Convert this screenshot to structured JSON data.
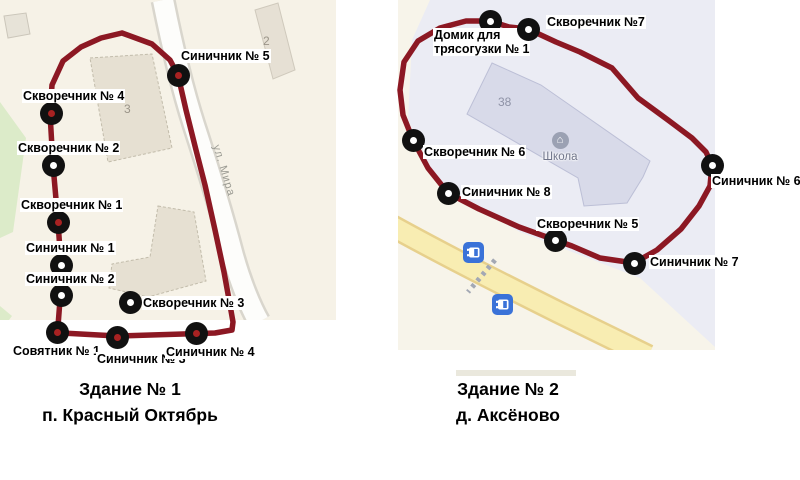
{
  "colors": {
    "route": "#8c1823",
    "marker_ring": "#111111",
    "marker_dot_red": "#a82222",
    "marker_dot_white": "#ffffff",
    "bus_badge_blue": "#3a72d8",
    "school_building": "#d8dae9",
    "map1_background": "#f6f2e7",
    "map2_background": "#ebecf4",
    "yellow_road": "#f8edb2"
  },
  "maps": [
    {
      "id": "map-1",
      "caption_line1": "Здание № 1",
      "caption_line2": "п. Красный Октябрь",
      "street_label": "ул. Мира",
      "building_numbers": [
        "3",
        "2"
      ],
      "markers": [
        {
          "label": "Синичник № 5",
          "x": 178,
          "y": 75,
          "dot": "#a82222",
          "lx": 180,
          "ly": 49
        },
        {
          "label": "Скворечник № 4",
          "x": 51,
          "y": 113,
          "dot": "#a82222",
          "lx": 22,
          "ly": 89
        },
        {
          "label": "Скворечник № 2",
          "x": 53,
          "y": 165,
          "dot": "#ffffff",
          "lx": 17,
          "ly": 141
        },
        {
          "label": "Скворечник № 1",
          "x": 58,
          "y": 222,
          "dot": "#a82222",
          "lx": 20,
          "ly": 198
        },
        {
          "label": "Синичник № 1",
          "x": 61,
          "y": 265,
          "dot": "#ffffff",
          "lx": 25,
          "ly": 241
        },
        {
          "label": "Синичник № 2",
          "x": 61,
          "y": 295,
          "dot": "#ffffff",
          "lx": 25,
          "ly": 272
        },
        {
          "label": "Скворечник № 3",
          "x": 130,
          "y": 302,
          "dot": "#ffffff",
          "lx": 142,
          "ly": 296
        },
        {
          "label": "Совятник № 1",
          "x": 57,
          "y": 332,
          "dot": "#a82222",
          "lx": 12,
          "ly": 344
        },
        {
          "label": "Синичник № 3",
          "x": 117,
          "y": 337,
          "dot": "#a82222",
          "lx": 96,
          "ly": 352
        },
        {
          "label": "Синичник № 4",
          "x": 196,
          "y": 333,
          "dot": "#a82222",
          "lx": 165,
          "ly": 345
        }
      ]
    },
    {
      "id": "map-2",
      "caption_line1": "Здание № 2",
      "caption_line2": "д. Аксёново",
      "school_label": "Школа",
      "building_number": "38",
      "markers": [
        {
          "label": "Домик для\nтрясогузки № 1",
          "x": 490,
          "y": 21,
          "dot": "#ffffff",
          "lx": 433,
          "ly": 28
        },
        {
          "label": "Скворечник №7",
          "x": 528,
          "y": 29,
          "dot": "#ffffff",
          "lx": 546,
          "ly": 15
        },
        {
          "label": "Скворечник № 6",
          "x": 413,
          "y": 140,
          "dot": "#ffffff",
          "lx": 423,
          "ly": 145
        },
        {
          "label": "Синичник № 8",
          "x": 448,
          "y": 193,
          "dot": "#ffffff",
          "lx": 461,
          "ly": 185
        },
        {
          "label": "Скворечник № 5",
          "x": 555,
          "y": 240,
          "dot": "#ffffff",
          "lx": 536,
          "ly": 217
        },
        {
          "label": "Синичник № 6",
          "x": 712,
          "y": 165,
          "dot": "#ffffff",
          "lx": 711,
          "ly": 174
        },
        {
          "label": "Синичник № 7",
          "x": 634,
          "y": 263,
          "dot": "#ffffff",
          "lx": 649,
          "ly": 255
        }
      ],
      "bus_stops": [
        {
          "x": 473,
          "y": 252
        },
        {
          "x": 502,
          "y": 304
        }
      ]
    }
  ]
}
